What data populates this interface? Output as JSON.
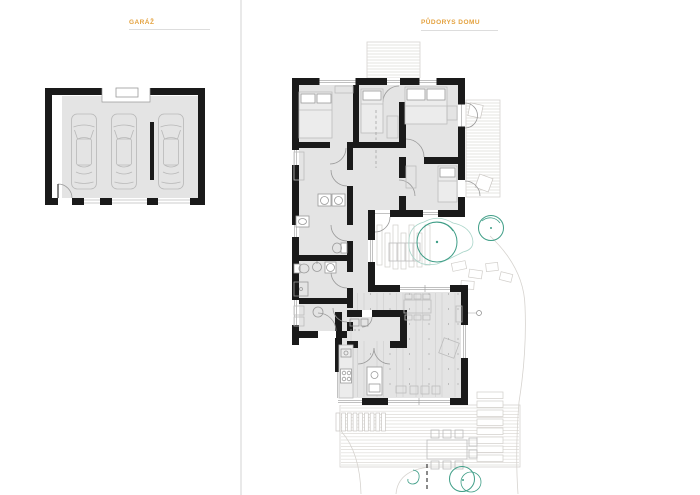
{
  "panels": {
    "garage": {
      "title": "GARÁŽ"
    },
    "house": {
      "title": "PŮDORYS DOMU"
    }
  },
  "colors": {
    "title_accent": "#E4A23F",
    "title_underline": "#DDDDDD",
    "panel_divider": "#E9E9E9",
    "wall": "#1A1A1A",
    "floor": "#E4E4E4",
    "furniture_line": "#BCBCBC",
    "deck_line": "#D9D6D2",
    "vegetation_teal": "#3F9E87"
  },
  "plan": {
    "garage": {
      "car_count": 3,
      "garage_door_count": 3
    },
    "house": {
      "tree_count": 3,
      "deck_area_count": 3,
      "shrub_count": 5
    }
  }
}
